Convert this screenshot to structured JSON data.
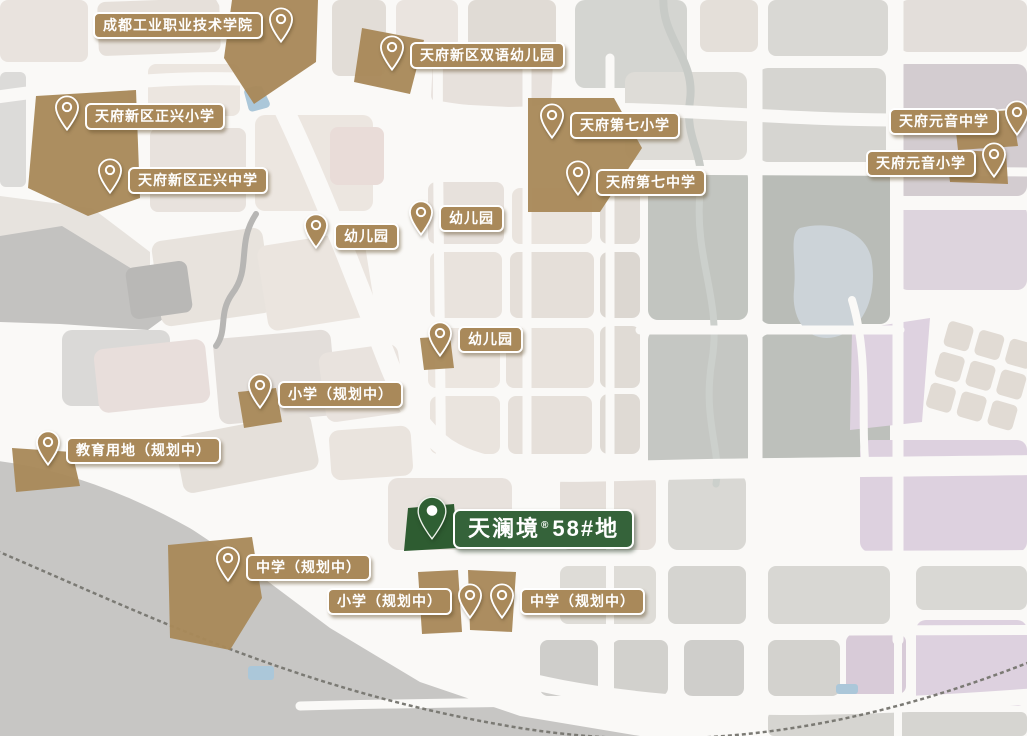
{
  "project": {
    "name": "天澜境",
    "reg_mark": "®",
    "plot": "58#地"
  },
  "markers": [
    {
      "id": "college",
      "label": "成都工业职业技术学院"
    },
    {
      "id": "bilingual-kindergarten",
      "label": "天府新区双语幼儿园"
    },
    {
      "id": "zhengxing-primary",
      "label": "天府新区正兴小学"
    },
    {
      "id": "zhengxing-middle",
      "label": "天府新区正兴中学"
    },
    {
      "id": "seventh-primary",
      "label": "天府第七小学"
    },
    {
      "id": "seventh-middle",
      "label": "天府第七中学"
    },
    {
      "id": "yuanyin-middle",
      "label": "天府元音中学"
    },
    {
      "id": "yuanyin-primary",
      "label": "天府元音小学"
    },
    {
      "id": "kindergarten-1",
      "label": "幼儿园"
    },
    {
      "id": "kindergarten-2",
      "label": "幼儿园"
    },
    {
      "id": "kindergarten-3",
      "label": "幼儿园"
    },
    {
      "id": "primary-planned-1",
      "label": "小学（规划中）"
    },
    {
      "id": "education-land-planned",
      "label": "教育用地（规划中）"
    },
    {
      "id": "middle-planned-1",
      "label": "中学（规划中）"
    },
    {
      "id": "primary-planned-2",
      "label": "小学（规划中）"
    },
    {
      "id": "middle-planned-2",
      "label": "中学（规划中）"
    }
  ],
  "colors": {
    "school_marker": "#a9895a",
    "project_marker": "#2e5c31",
    "project_label": "#35633a",
    "label_text": "#ffffff"
  }
}
